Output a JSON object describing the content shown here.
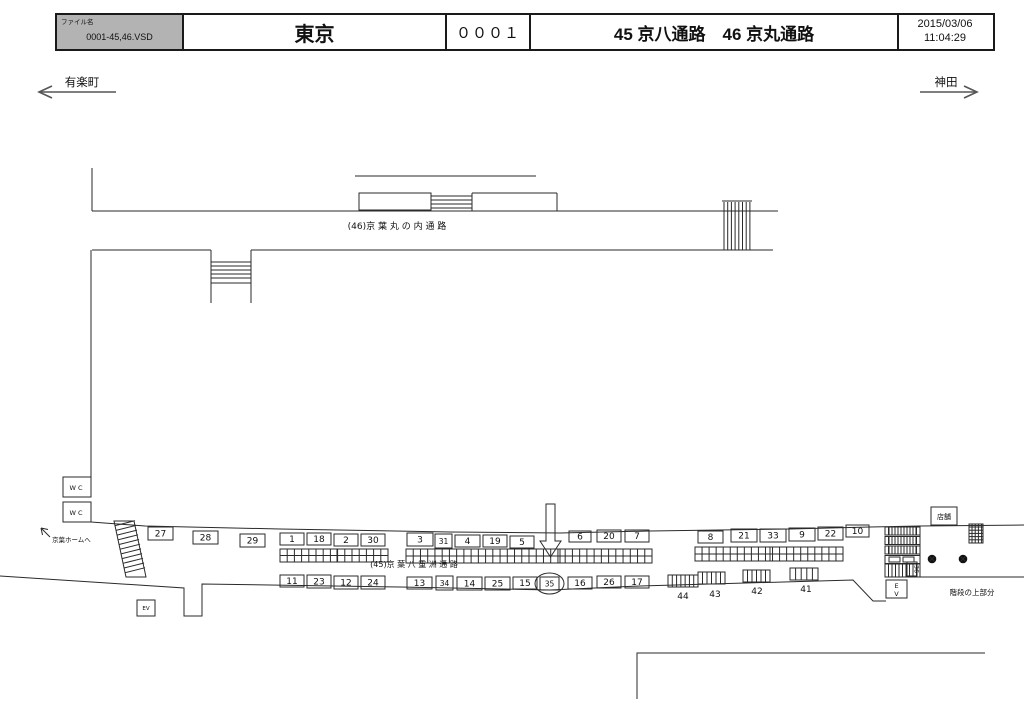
{
  "header": {
    "file_label": "ファイル名",
    "file_name": "0001-45,46.VSD",
    "station": "東京",
    "sheet_code": "０００１",
    "title": "45 京八通路　46 京丸通路",
    "date": "2015/03/06",
    "time": "11:04:29"
  },
  "directions": {
    "left": "有楽町",
    "right": "神田"
  },
  "colors": {
    "line": "#2a2a2a",
    "highlight": "#e60012",
    "gray_box_fill": "#b9b9b9",
    "header_gray": "#b3b3b3"
  },
  "diagram": {
    "corridor46_label": "(46)京 葉 丸 の 内 通 路",
    "corridor45_label": "(45)京 葉 八 重 洲 通 路",
    "to_keiyo_home": "京葉ホームへ",
    "wc": "WC",
    "shop": "店舗",
    "stairs_top": "階段の上部分",
    "ev_left": "EV",
    "ev_right": "EV",
    "rotated_number": "36",
    "highlighted_number": "35",
    "ad_boxes": [
      {
        "n": "27",
        "x": 148,
        "y": 527,
        "w": 25,
        "h": 13,
        "s": "b"
      },
      {
        "n": "28",
        "x": 193,
        "y": 531,
        "w": 25,
        "h": 13,
        "s": "b"
      },
      {
        "n": "29",
        "x": 240,
        "y": 534,
        "w": 25,
        "h": 13,
        "s": "b"
      },
      {
        "n": "1",
        "x": 280,
        "y": 533,
        "w": 24,
        "h": 12,
        "s": "p"
      },
      {
        "n": "18",
        "x": 307,
        "y": 533,
        "w": 24,
        "h": 12,
        "s": "p"
      },
      {
        "n": "2",
        "x": 334,
        "y": 534,
        "w": 24,
        "h": 12,
        "s": "p"
      },
      {
        "n": "30",
        "x": 361,
        "y": 534,
        "w": 24,
        "h": 12,
        "s": "p"
      },
      {
        "n": "3",
        "x": 407,
        "y": 533,
        "w": 26,
        "h": 13,
        "s": "p"
      },
      {
        "n": "31",
        "x": 435,
        "y": 534,
        "w": 17,
        "h": 14,
        "s": "g"
      },
      {
        "n": "4",
        "x": 455,
        "y": 535,
        "w": 25,
        "h": 12,
        "s": "p"
      },
      {
        "n": "19",
        "x": 483,
        "y": 535,
        "w": 24,
        "h": 12,
        "s": "p"
      },
      {
        "n": "5",
        "x": 510,
        "y": 536,
        "w": 24,
        "h": 12,
        "s": "p"
      },
      {
        "n": "6",
        "x": 569,
        "y": 531,
        "w": 22,
        "h": 11,
        "s": "p"
      },
      {
        "n": "20",
        "x": 597,
        "y": 530,
        "w": 24,
        "h": 12,
        "s": "p"
      },
      {
        "n": "7",
        "x": 625,
        "y": 530,
        "w": 24,
        "h": 12,
        "s": "p"
      },
      {
        "n": "8",
        "x": 698,
        "y": 531,
        "w": 25,
        "h": 12,
        "s": "b"
      },
      {
        "n": "21",
        "x": 731,
        "y": 529,
        "w": 26,
        "h": 13,
        "s": "b"
      },
      {
        "n": "33",
        "x": 760,
        "y": 529,
        "w": 26,
        "h": 13,
        "s": "b"
      },
      {
        "n": "9",
        "x": 789,
        "y": 528,
        "w": 26,
        "h": 13,
        "s": "b"
      },
      {
        "n": "22",
        "x": 818,
        "y": 527,
        "w": 25,
        "h": 13,
        "s": "b"
      },
      {
        "n": "10",
        "x": 846,
        "y": 525,
        "w": 23,
        "h": 12,
        "s": "b"
      },
      {
        "n": "11",
        "x": 280,
        "y": 575,
        "w": 24,
        "h": 12,
        "s": "b"
      },
      {
        "n": "23",
        "x": 307,
        "y": 575,
        "w": 24,
        "h": 13,
        "s": "b"
      },
      {
        "n": "12",
        "x": 334,
        "y": 576,
        "w": 24,
        "h": 13,
        "s": "b"
      },
      {
        "n": "24",
        "x": 361,
        "y": 576,
        "w": 24,
        "h": 13,
        "s": "b"
      },
      {
        "n": "13",
        "x": 407,
        "y": 577,
        "w": 25,
        "h": 12,
        "s": "b"
      },
      {
        "n": "34",
        "x": 436,
        "y": 576,
        "w": 17,
        "h": 14,
        "s": "g"
      },
      {
        "n": "14",
        "x": 457,
        "y": 577,
        "w": 25,
        "h": 13,
        "s": "b"
      },
      {
        "n": "25",
        "x": 485,
        "y": 577,
        "w": 25,
        "h": 13,
        "s": "b"
      },
      {
        "n": "15",
        "x": 513,
        "y": 577,
        "w": 24,
        "h": 12,
        "s": "b"
      },
      {
        "n": "35",
        "x": 540,
        "y": 577,
        "w": 19,
        "h": 13,
        "s": "g"
      },
      {
        "n": "16",
        "x": 568,
        "y": 577,
        "w": 24,
        "h": 12,
        "s": "b"
      },
      {
        "n": "26",
        "x": 597,
        "y": 576,
        "w": 24,
        "h": 12,
        "s": "b"
      },
      {
        "n": "17",
        "x": 625,
        "y": 576,
        "w": 24,
        "h": 12,
        "s": "b"
      }
    ],
    "pillar_groups": [
      {
        "label": "44",
        "x": 668,
        "y": 575,
        "w": 30,
        "h": 12,
        "cells": 7,
        "lx": 683,
        "ly": 599
      },
      {
        "label": "43",
        "x": 698,
        "y": 572,
        "w": 27,
        "h": 12,
        "cells": 6,
        "lx": 715,
        "ly": 597
      },
      {
        "label": "42",
        "x": 743,
        "y": 570,
        "w": 27,
        "h": 12,
        "cells": 6,
        "lx": 757,
        "ly": 594
      },
      {
        "label": "41",
        "x": 790,
        "y": 568,
        "w": 28,
        "h": 12,
        "cells": 5,
        "lx": 806,
        "ly": 592
      }
    ],
    "strips": [
      {
        "x": 280,
        "y": 549,
        "w": 108,
        "h": 13,
        "cols": 15,
        "div": 337
      },
      {
        "x": 406,
        "y": 549,
        "w": 246,
        "h": 14,
        "cols": 34,
        "div": 560
      },
      {
        "x": 695,
        "y": 547,
        "w": 148,
        "h": 14,
        "cols": 21,
        "div": 770
      }
    ]
  }
}
